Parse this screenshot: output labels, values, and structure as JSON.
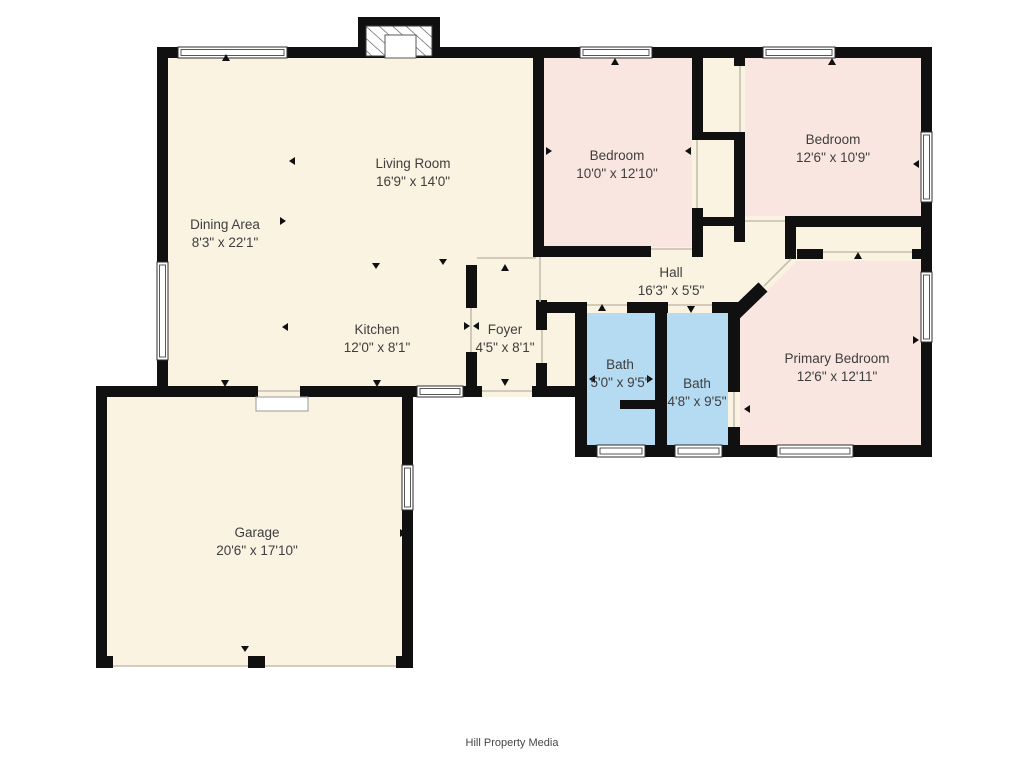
{
  "palette": {
    "floor_cream": "#faf3e1",
    "bedroom_pink": "#f9e6e0",
    "bath_blue": "#b5dbf3",
    "wall_black": "#101010",
    "label_text": "#3e3e3e",
    "background": "#ffffff"
  },
  "rooms": [
    {
      "id": "living-room",
      "name": "Living Room",
      "dims": "16'9\" x 14'0\""
    },
    {
      "id": "dining-area",
      "name": "Dining Area",
      "dims": "8'3\" x 22'1\""
    },
    {
      "id": "bedroom-1",
      "name": "Bedroom",
      "dims": "10'0\" x 12'10\""
    },
    {
      "id": "bedroom-2",
      "name": "Bedroom",
      "dims": "12'6\" x 10'9\""
    },
    {
      "id": "hall",
      "name": "Hall",
      "dims": "16'3\" x 5'5\""
    },
    {
      "id": "kitchen",
      "name": "Kitchen",
      "dims": "12'0\" x 8'1\""
    },
    {
      "id": "foyer",
      "name": "Foyer",
      "dims": "4'5\" x 8'1\""
    },
    {
      "id": "bath-1",
      "name": "Bath",
      "dims": "5'0\" x 9'5\""
    },
    {
      "id": "bath-2",
      "name": "Bath",
      "dims": "4'8\" x 9'5\""
    },
    {
      "id": "primary-bedroom",
      "name": "Primary Bedroom",
      "dims": "12'6\" x 12'11\""
    },
    {
      "id": "garage",
      "name": "Garage",
      "dims": "20'6\" x 17'10\""
    }
  ],
  "footer": {
    "credit": "Hill Property Media"
  }
}
